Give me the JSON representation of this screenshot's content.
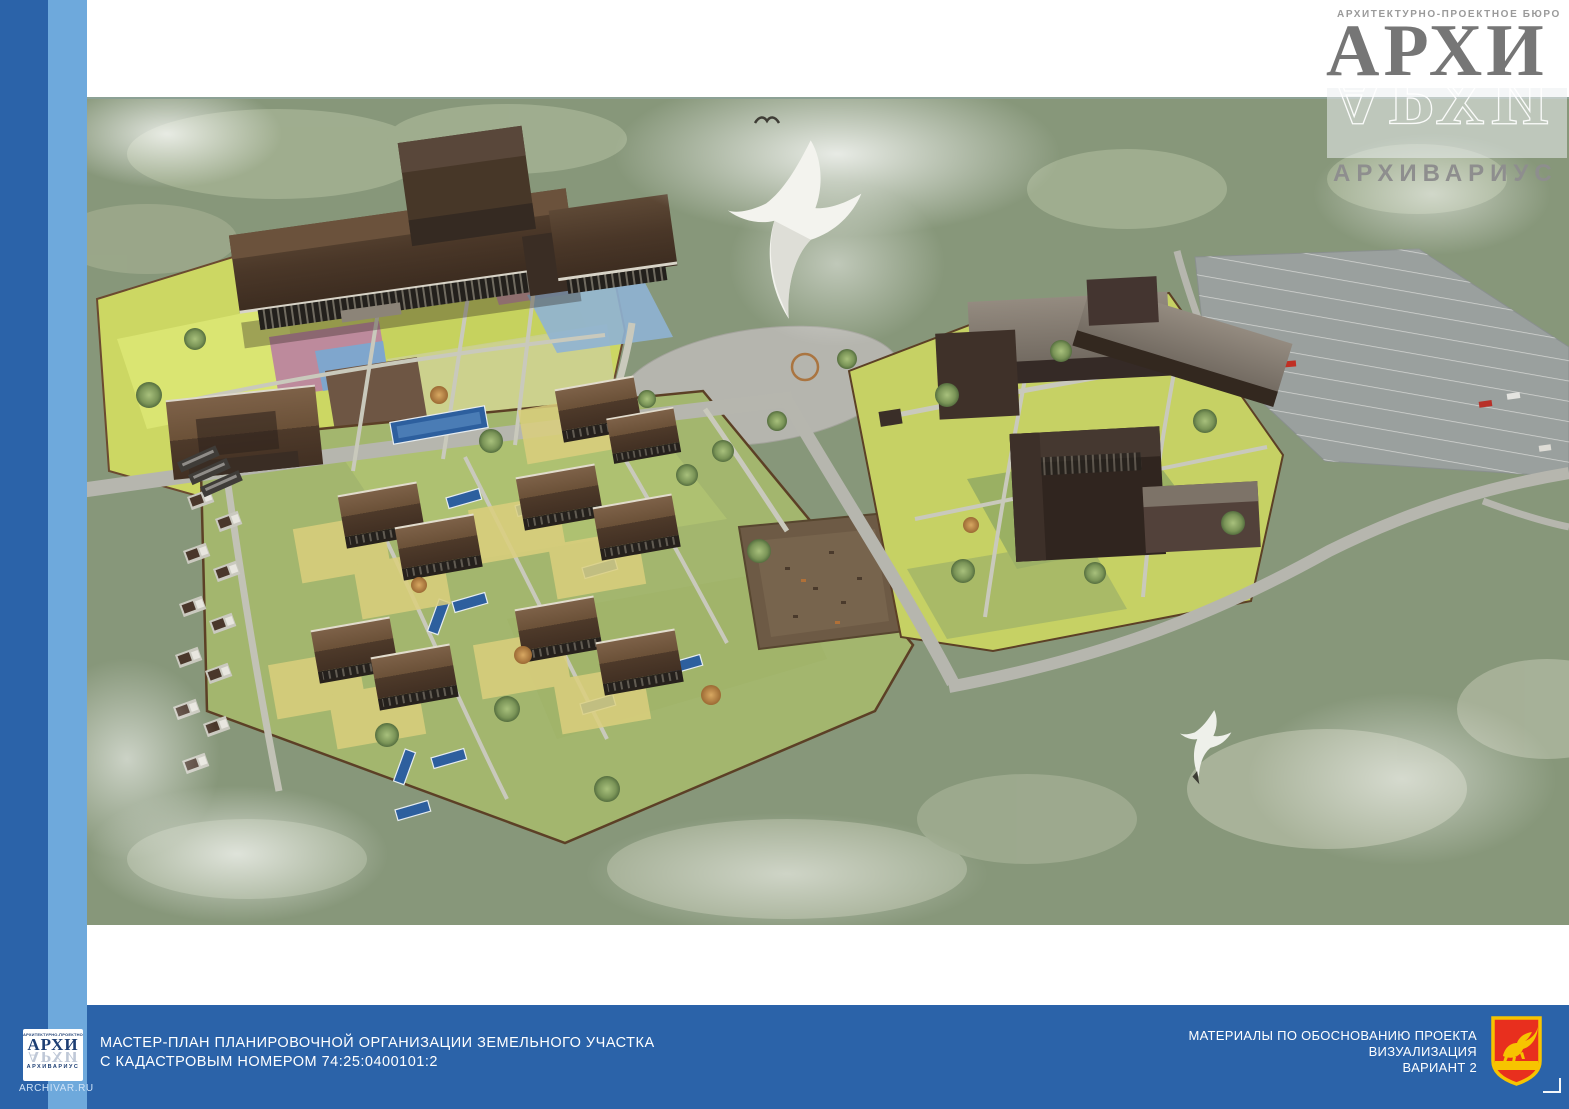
{
  "header": {
    "bureau_line": "АРХИТЕКТУРНО-ПРОЕКТНОЕ БЮРО",
    "logo_main": "АРХИ",
    "logo_reflection": "АРХИ",
    "logo_sub": "АРХИВАРИУС"
  },
  "footer": {
    "title_line1": "МАСТЕР-ПЛАН ПЛАНИРОВОЧНОЙ ОРГАНИЗАЦИИ ЗЕМЕЛЬНОГО УЧАСТКА",
    "title_line2": "С КАДАСТРОВЫМ НОМЕРОМ 74:25:0400101:2",
    "right_line1": "МАТЕРИАЛЫ ПО ОБОСНОВАНИЮ ПРОЕКТА",
    "right_line2": "ВИЗУАЛИЗАЦИЯ",
    "right_line3": "ВАРИАНТ 2",
    "logo_box": {
      "top_line": "АРХИТЕКТУРНО-ПРОЕКТНОЕ БЮРО",
      "main": "АРХИ",
      "reflection": "АРХИ",
      "sub": "АРХИВАРИУС",
      "url": "ARCHIVAR.RU"
    }
  },
  "colors": {
    "footer_bar": "#2b63a9",
    "stripe_dark": "#2b63a9",
    "stripe_light": "#6ea9dc",
    "logo_navy": "#1d3e73",
    "logo_gray": "#767676",
    "emblem_red": "#e82f1e",
    "emblem_gold": "#f7c400",
    "site_lawn": "#ccd763",
    "pool_blue": "#2d5f9e",
    "roof_brown": "#4e3a2a"
  }
}
